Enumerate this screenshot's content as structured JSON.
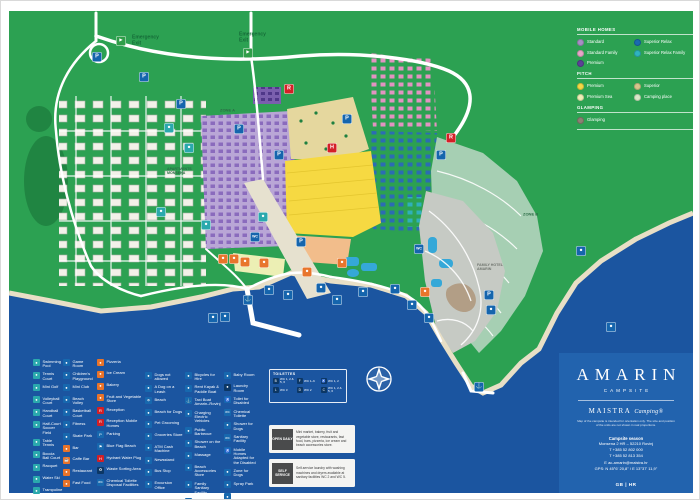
{
  "map": {
    "labels": [
      {
        "text": "Emergency\nExit",
        "x": 131,
        "y": 40,
        "color": "#156b38",
        "size": 5
      },
      {
        "text": "Emergency\nExit",
        "x": 238,
        "y": 37,
        "color": "#156b38",
        "size": 5
      },
      {
        "text": "ZONE A",
        "x": 219,
        "y": 110,
        "color": "#2c6b46",
        "size": 4
      },
      {
        "text": "ZONE B",
        "x": 522,
        "y": 214,
        "color": "#2c6b46",
        "size": 4
      },
      {
        "text": "APARTMENTS\nMONSENA",
        "x": 166,
        "y": 170,
        "color": "#2c6b46",
        "size": 3.6
      },
      {
        "text": "FAMILY HOTEL\nAMARIN",
        "x": 476,
        "y": 266,
        "color": "#70756f",
        "size": 3.6
      }
    ],
    "markers": [
      {
        "x": 120,
        "y": 40,
        "c": "#2f9e49",
        "g": "►",
        "n": "emergency-exit-icon"
      },
      {
        "x": 247,
        "y": 52,
        "c": "#2f9e49",
        "g": "►",
        "n": "emergency-exit-icon"
      },
      {
        "x": 96,
        "y": 56,
        "c": "#1565ad",
        "g": "P",
        "n": "parking-icon"
      },
      {
        "x": 143,
        "y": 76,
        "c": "#1565ad",
        "g": "P",
        "n": "parking-icon"
      },
      {
        "x": 180,
        "y": 103,
        "c": "#1565ad",
        "g": "P",
        "n": "parking-icon"
      },
      {
        "x": 238,
        "y": 128,
        "c": "#1565ad",
        "g": "P",
        "n": "parking-icon"
      },
      {
        "x": 278,
        "y": 154,
        "c": "#1565ad",
        "g": "P",
        "n": "parking-icon"
      },
      {
        "x": 300,
        "y": 241,
        "c": "#1565ad",
        "g": "P",
        "n": "parking-icon"
      },
      {
        "x": 346,
        "y": 118,
        "c": "#1565ad",
        "g": "P",
        "n": "parking-icon"
      },
      {
        "x": 440,
        "y": 154,
        "c": "#1565ad",
        "g": "P",
        "n": "parking-icon"
      },
      {
        "x": 488,
        "y": 294,
        "c": "#1565ad",
        "g": "P",
        "n": "parking-icon"
      },
      {
        "x": 288,
        "y": 88,
        "c": "#d42027",
        "g": "R",
        "n": "reception-icon"
      },
      {
        "x": 450,
        "y": 137,
        "c": "#d42027",
        "g": "R",
        "n": "reception-mobile-homes-icon"
      },
      {
        "x": 331,
        "y": 147,
        "c": "#d42027",
        "g": "H",
        "n": "hydrant-icon"
      },
      {
        "x": 222,
        "y": 258,
        "c": "#e8752c",
        "g": "●",
        "n": "restaurant-icon"
      },
      {
        "x": 233,
        "y": 258,
        "c": "#e8752c",
        "g": "●",
        "n": "bar-icon"
      },
      {
        "x": 244,
        "y": 261,
        "c": "#e8752c",
        "g": "●",
        "n": "fast-food-icon"
      },
      {
        "x": 263,
        "y": 262,
        "c": "#e8752c",
        "g": "●",
        "n": "pizzeria-icon"
      },
      {
        "x": 306,
        "y": 271,
        "c": "#e8752c",
        "g": "●",
        "n": "ice-cream-icon"
      },
      {
        "x": 341,
        "y": 262,
        "c": "#e8752c",
        "g": "●",
        "n": "bakery-icon"
      },
      {
        "x": 424,
        "y": 291,
        "c": "#e8752c",
        "g": "●",
        "n": "beach-bar-icon"
      },
      {
        "x": 168,
        "y": 127,
        "c": "#2aa9ad",
        "g": "●",
        "n": "sports-icon"
      },
      {
        "x": 188,
        "y": 147,
        "c": "#2aa9ad",
        "g": "●",
        "n": "sports-icon"
      },
      {
        "x": 160,
        "y": 211,
        "c": "#2aa9ad",
        "g": "●",
        "n": "sports-icon"
      },
      {
        "x": 205,
        "y": 224,
        "c": "#2aa9ad",
        "g": "●",
        "n": "sports-icon"
      },
      {
        "x": 262,
        "y": 216,
        "c": "#2aa9ad",
        "g": "●",
        "n": "sports-icon"
      },
      {
        "x": 254,
        "y": 236,
        "c": "#1565ad",
        "g": "WC",
        "n": "sanitary-icon"
      },
      {
        "x": 418,
        "y": 248,
        "c": "#1565ad",
        "g": "WC",
        "n": "sanitary-icon"
      },
      {
        "x": 212,
        "y": 317,
        "c": "#1565ad",
        "g": "●",
        "n": "water-sports-icon"
      },
      {
        "x": 224,
        "y": 316,
        "c": "#1565ad",
        "g": "●",
        "n": "water-sports-icon"
      },
      {
        "x": 247,
        "y": 299,
        "c": "#1565ad",
        "g": "⚓",
        "n": "pier-icon"
      },
      {
        "x": 268,
        "y": 289,
        "c": "#1565ad",
        "g": "●",
        "n": "beach-icon"
      },
      {
        "x": 287,
        "y": 294,
        "c": "#1565ad",
        "g": "●",
        "n": "beach-icon"
      },
      {
        "x": 320,
        "y": 287,
        "c": "#1565ad",
        "g": "●",
        "n": "beach-icon"
      },
      {
        "x": 336,
        "y": 299,
        "c": "#1565ad",
        "g": "●",
        "n": "shower-icon"
      },
      {
        "x": 362,
        "y": 291,
        "c": "#1565ad",
        "g": "●",
        "n": "pool-icon"
      },
      {
        "x": 394,
        "y": 288,
        "c": "#1565ad",
        "g": "●",
        "n": "beach-icon"
      },
      {
        "x": 411,
        "y": 304,
        "c": "#1565ad",
        "g": "●",
        "n": "beach-icon"
      },
      {
        "x": 428,
        "y": 317,
        "c": "#1565ad",
        "g": "●",
        "n": "beach-icon"
      },
      {
        "x": 478,
        "y": 386,
        "c": "#1565ad",
        "g": "⚓",
        "n": "marina-icon"
      },
      {
        "x": 490,
        "y": 309,
        "c": "#1565ad",
        "g": "●",
        "n": "beach-icon"
      },
      {
        "x": 580,
        "y": 250,
        "c": "#1565ad",
        "g": "●",
        "n": "beach-icon"
      },
      {
        "x": 610,
        "y": 326,
        "c": "#1565ad",
        "g": "●",
        "n": "beach-icon"
      }
    ]
  },
  "map_key": {
    "sections": [
      {
        "title": "MOBILE HOMES",
        "items": [
          {
            "label": "Standard",
            "color": "#a78fc5"
          },
          {
            "label": "Superior Relax",
            "color": "#1a6ab0"
          },
          {
            "label": "Standard Family",
            "color": "#e7a6c8"
          },
          {
            "label": "Superior Relax Family",
            "color": "#2fb3c0"
          },
          {
            "label": "Premium",
            "color": "#5c4197"
          },
          {
            "label": "",
            "color": "transparent"
          }
        ]
      },
      {
        "title": "PITCH",
        "items": [
          {
            "label": "Premium",
            "color": "#f3d844"
          },
          {
            "label": "Superior",
            "color": "#d6c58b"
          },
          {
            "label": "Premium Sea",
            "color": "#edefb6"
          },
          {
            "label": "Camping place",
            "color": "#d8e8c8"
          }
        ]
      },
      {
        "title": "GLAMPING",
        "items": [
          {
            "label": "Glamping",
            "color": "#8b8173"
          }
        ]
      }
    ]
  },
  "facilities_legend": {
    "columns": [
      {
        "items": [
          {
            "label": "Swimming Pool",
            "color": "#2aa9ad",
            "g": "●"
          },
          {
            "label": "Tennis Court",
            "color": "#2aa9ad",
            "g": "●"
          },
          {
            "label": "Mini Golf",
            "color": "#2aa9ad",
            "g": "●"
          },
          {
            "label": "Volleyball Court",
            "color": "#2aa9ad",
            "g": "●"
          },
          {
            "label": "Handball Court",
            "color": "#2aa9ad",
            "g": "●"
          },
          {
            "label": "Half-Court Soccer Field",
            "color": "#2aa9ad",
            "g": "●"
          },
          {
            "label": "Table Tennis",
            "color": "#2aa9ad",
            "g": "●"
          },
          {
            "label": "Boccia Ball Court",
            "color": "#2aa9ad",
            "g": "●"
          },
          {
            "label": "Racquet",
            "color": "#2aa9ad",
            "g": "●"
          },
          {
            "label": "Water Ski",
            "color": "#2aa9ad",
            "g": "●"
          },
          {
            "label": "Trampoline",
            "color": "#2aa9ad",
            "g": "●"
          }
        ]
      },
      {
        "items": [
          {
            "label": "Game Room",
            "color": "#1768ae",
            "g": "●"
          },
          {
            "label": "Children's Playground",
            "color": "#1768ae",
            "g": "●"
          },
          {
            "label": "Mini Club",
            "color": "#1768ae",
            "g": "●"
          },
          {
            "label": "Beach Volley",
            "color": "#1768ae",
            "g": "●"
          },
          {
            "label": "Basketball Court",
            "color": "#1768ae",
            "g": "●"
          },
          {
            "label": "Fitness",
            "color": "#1768ae",
            "g": "●"
          },
          {
            "label": "Skate Park",
            "color": "#1768ae",
            "g": "●"
          },
          {
            "label": "Bar",
            "color": "#e8732a",
            "g": "●"
          },
          {
            "label": "Caffe Bar",
            "color": "#e8732a",
            "g": "☕"
          },
          {
            "label": "Restaurant",
            "color": "#e8732a",
            "g": "●"
          },
          {
            "label": "Fast Food",
            "color": "#e8732a",
            "g": "●"
          }
        ]
      },
      {
        "items": [
          {
            "label": "Pizzeria",
            "color": "#e8732a",
            "g": "●"
          },
          {
            "label": "Ice Cream",
            "color": "#e8732a",
            "g": "●"
          },
          {
            "label": "Bakery",
            "color": "#e8732a",
            "g": "●"
          },
          {
            "label": "Fruit and Vegetable Store",
            "color": "#e8732a",
            "g": "●"
          },
          {
            "label": "Reception",
            "color": "#d21f26",
            "g": "R"
          },
          {
            "label": "Reception Mobile Homes",
            "color": "#d21f26",
            "g": "R"
          },
          {
            "label": "Parking",
            "color": "#1768ae",
            "g": "P"
          },
          {
            "label": "Blue Flag Beach",
            "color": "#1768ae",
            "g": "⚑"
          },
          {
            "label": "Hydrant Water Plug",
            "color": "#d21f26",
            "g": "H"
          },
          {
            "label": "Waste Sorting Area",
            "color": "#0c3765",
            "g": "♻"
          },
          {
            "label": "Chemical Toilette Disposal Facilities",
            "color": "#1768ae",
            "g": "WC"
          }
        ]
      },
      {
        "items": [
          {
            "label": "Dogs not allowed",
            "color": "#1768ae",
            "g": "●"
          },
          {
            "label": "A Dog on a Leash",
            "color": "#1768ae",
            "g": "●"
          },
          {
            "label": "Beach",
            "color": "#1768ae",
            "g": "☂"
          },
          {
            "label": "Beach for Dogs",
            "color": "#1768ae",
            "g": "●"
          },
          {
            "label": "Pet Grooming",
            "color": "#1768ae",
            "g": "●"
          },
          {
            "label": "Groceries Store",
            "color": "#1768ae",
            "g": "●"
          },
          {
            "label": "ATM Cash Machine",
            "color": "#1768ae",
            "g": "●"
          },
          {
            "label": "Newsstand",
            "color": "#1768ae",
            "g": "●"
          },
          {
            "label": "Bus Stop",
            "color": "#1768ae",
            "g": "●"
          },
          {
            "label": "Excursion Office",
            "color": "#1768ae",
            "g": "●"
          }
        ]
      },
      {
        "items": [
          {
            "label": "Bicycles for Hire",
            "color": "#1768ae",
            "g": "●"
          },
          {
            "label": "Rent Kayak & Paddle Boat",
            "color": "#1768ae",
            "g": "●"
          },
          {
            "label": "Taxi Boat Amarin–Rovinj",
            "color": "#1768ae",
            "g": "⚓"
          },
          {
            "label": "Charging Electric Vehicles",
            "color": "#1768ae",
            "g": "●"
          },
          {
            "label": "Public Barbecue",
            "color": "#1768ae",
            "g": "●"
          },
          {
            "label": "Shower on the Beach",
            "color": "#1768ae",
            "g": "●"
          },
          {
            "label": "Massage",
            "color": "#1768ae",
            "g": "●"
          },
          {
            "label": "Beach Accessories Store",
            "color": "#1768ae",
            "g": "●"
          },
          {
            "label": "Family Sanitary Facility",
            "color": "#1768ae",
            "g": "●"
          },
          {
            "label": "Toilette for Children",
            "color": "#1768ae",
            "g": "WC"
          }
        ]
      },
      {
        "items": [
          {
            "label": "Baby Room",
            "color": "#1768ae",
            "g": "●"
          },
          {
            "label": "Laundry Room",
            "color": "#0c3765",
            "g": "●"
          },
          {
            "label": "Toilet for Disabled",
            "color": "#1768ae",
            "g": "♿"
          },
          {
            "label": "Chemical Toilette",
            "color": "#1768ae",
            "g": "WC"
          },
          {
            "label": "Shower for Dogs",
            "color": "#1768ae",
            "g": "●"
          },
          {
            "label": "Sanitary Facility",
            "color": "#1768ae",
            "g": "WC"
          },
          {
            "label": "Mobile Homes Adapted for the Disabled",
            "color": "#1768ae",
            "g": "♿"
          },
          {
            "label": "Zone for Dogs",
            "color": "#1768ae",
            "g": "●"
          },
          {
            "label": "Spray Park",
            "color": "#1768ae",
            "g": "●"
          },
          {
            "label": "Rent a Sunbed",
            "color": "#1768ae",
            "g": "●"
          }
        ]
      }
    ]
  },
  "toilettes": {
    "title": "TOILETTES",
    "groups": [
      {
        "g": "B",
        "label": "WC 1, 2 & 5, 6"
      },
      {
        "g": "F",
        "label": "WC 1–6"
      },
      {
        "g": "♿",
        "label": "WC 1, 2"
      },
      {
        "g": "L",
        "label": "WC 3"
      },
      {
        "g": "D",
        "label": "WC 2"
      },
      {
        "g": "C",
        "label": "WC 1, 2 & 5, 6"
      }
    ]
  },
  "service_boxes": {
    "open_daily": {
      "tag": "OPEN DAILY",
      "text": "Mini market, bakery, fruit and vegetable store, restaurants, fast food, bars, pizzeria, ice cream and beach accessories store."
    },
    "self_service": {
      "tag": "SELF SERVICE",
      "text": "Self-service laundry with washing machines and dryers available at sanitary facilities WC 2 and WC 5."
    }
  },
  "brand_panel": {
    "name": "AMARIN",
    "subtitle": "CAMPSITE",
    "logo": "MAISTRA",
    "logo_script": "Camping®",
    "disclaimer": "Map of the campsite is intended for orientation only. The size and position of the units are not shown in real proportions.",
    "season_title": "Campsite season",
    "address": "Monsena 2 HR – 52210 Rovinj",
    "phone1": "T +385 52 802 000",
    "phone2": "T +385 52 813 354",
    "email": "E ac-amarin@maistra.hr",
    "gps": "GPS: N 45°6' 20,8'' / E 13°37' 11,9''",
    "lang": "GB | HR"
  }
}
